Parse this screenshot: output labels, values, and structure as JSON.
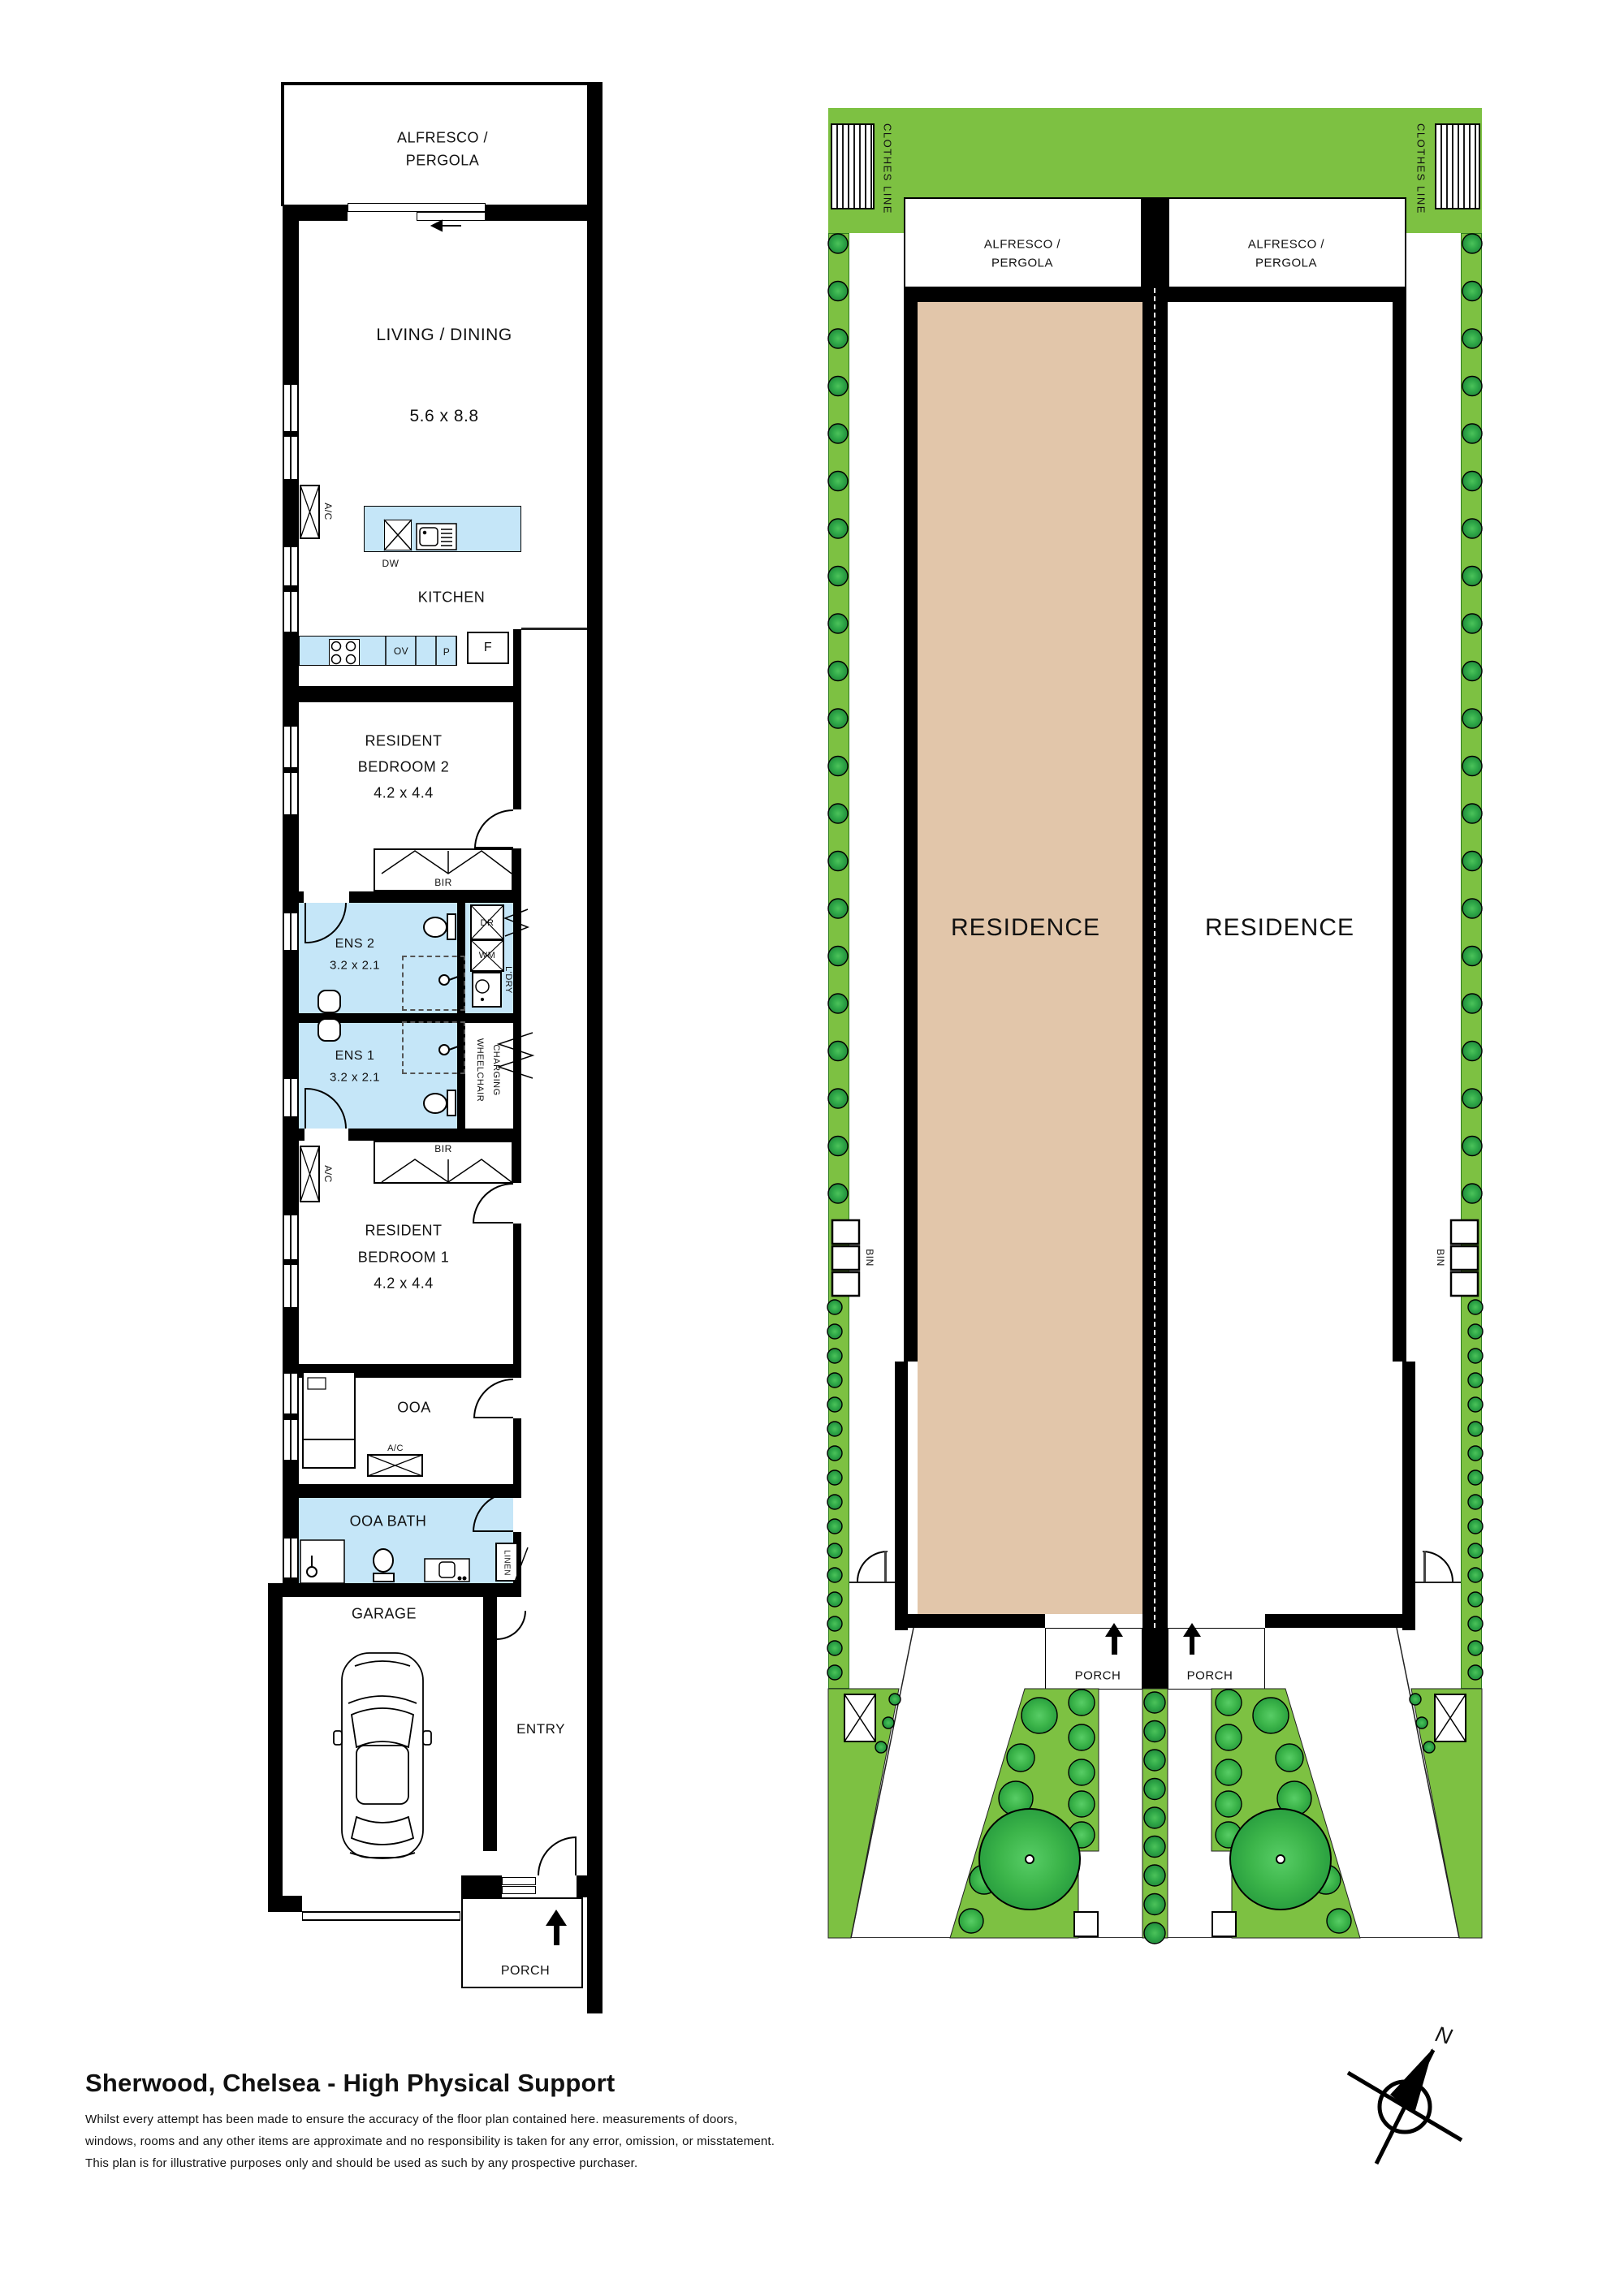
{
  "fp": {
    "alfresco_l1": "ALFRESCO /",
    "alfresco_l2": "PERGOLA",
    "living": "LIVING / DINING",
    "living_dims": "5.6 x 8.8",
    "kitchen": "KITCHEN",
    "dw": "DW",
    "ov": "OV",
    "p": "P",
    "f": "F",
    "resident": "RESIDENT",
    "bedroom2": "BEDROOM 2",
    "bedroom1": "BEDROOM 1",
    "bed_dims": "4.2 x 4.4",
    "bir": "BIR",
    "ens2": "ENS 2",
    "ens1": "ENS 1",
    "ens_dims": "3.2 x 2.1",
    "dr": "DR",
    "wm": "WM",
    "ldry": "L'DRY",
    "wheelchair": "WHEELCHAIR",
    "charging": "CHARGING",
    "ac": "A/C",
    "ooa": "OOA",
    "ooa_bath": "OOA BATH",
    "linen": "LINEN",
    "garage": "GARAGE",
    "entry": "ENTRY",
    "porch": "PORCH"
  },
  "site": {
    "clothes_line": "CLOTHES LINE",
    "alfresco_l1": "ALFRESCO /",
    "alfresco_l2": "PERGOLA",
    "residence": "RESIDENCE",
    "bin": "BIN",
    "porch": "PORCH"
  },
  "footer": {
    "title": "Sherwood, Chelsea - High Physical Support",
    "disclaimer_line1": "Whilst every attempt has been made to ensure the accuracy of the floor plan contained here. measurements of doors,",
    "disclaimer_line2": "windows, rooms and any other items are approximate and no responsibility is taken for any error, omission, or misstatement.",
    "disclaimer_line3": "This plan is for illustrative purposes only and should be used as such by any prospective purchaser."
  },
  "compass": {
    "north": "N"
  },
  "colors": {
    "garden_green": "#7DC142",
    "tree_green": "#2FA848",
    "big_tree_green": "#3CB54A",
    "residence_fill": "#E2C6AA",
    "wet_area_blue": "#C5E6F8",
    "wall_black": "#000000"
  }
}
